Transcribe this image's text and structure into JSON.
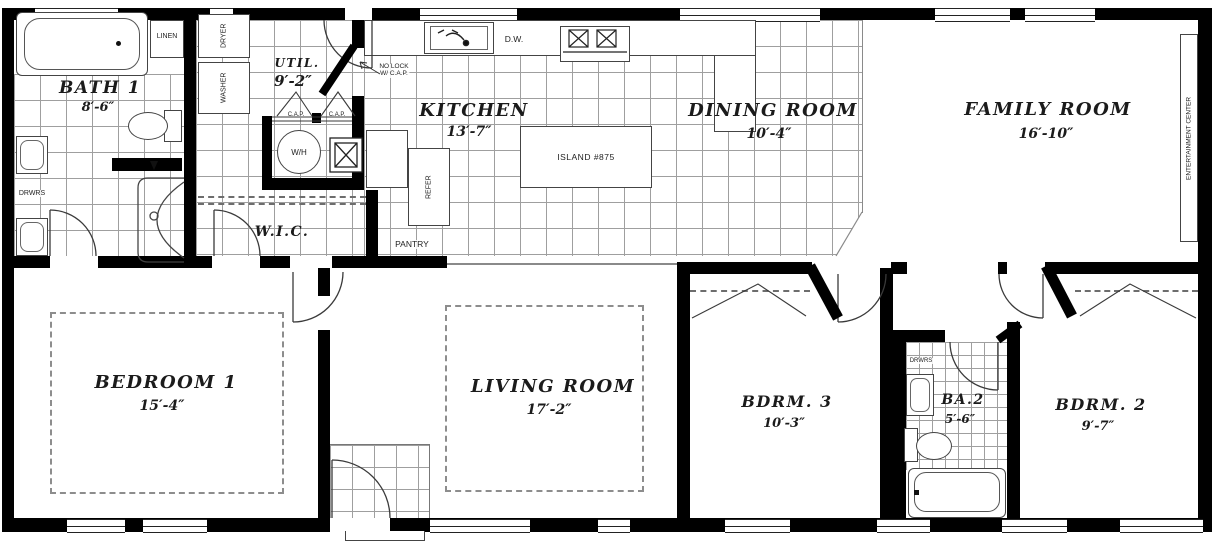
{
  "rooms": {
    "bath1": {
      "name": "BATH 1",
      "dim": "8′-6″"
    },
    "util": {
      "name": "UTIL.",
      "dim": "9′-2″"
    },
    "kitchen": {
      "name": "KITCHEN",
      "dim": "13′-7″"
    },
    "dining": {
      "name": "DINING ROOM",
      "dim": "10′-4″"
    },
    "family": {
      "name": "FAMILY ROOM",
      "dim": "16′-10″"
    },
    "bedroom1": {
      "name": "BEDROOM 1",
      "dim": "15′-4″"
    },
    "living": {
      "name": "LIVING ROOM",
      "dim": "17′-2″"
    },
    "bdrm3": {
      "name": "BDRM. 3",
      "dim": "10′-3″"
    },
    "ba2": {
      "name": "BA.2",
      "dim": "5′-6″"
    },
    "bdrm2": {
      "name": "BDRM. 2",
      "dim": "9′-7″"
    },
    "wic": {
      "name": "W.I.C."
    }
  },
  "fixtures": {
    "linen": "LINEN",
    "dryer": "DRYER",
    "washer": "WASHER",
    "drwrs_bath": "DRWRS",
    "wh": "W/H",
    "cap_left": "C.A.P.",
    "cap_right": "C.A.P.",
    "no_lock_1": "NO LOCK",
    "no_lock_2": "W/ C.A.P.",
    "dw": "D.W.",
    "island": "ISLAND #875",
    "refer": "REFER",
    "pantry": "PANTRY",
    "entertainment": "ENTERTAINMENT CENTER",
    "drwrs_ba2": "DRWRS"
  },
  "colors": {
    "wall": "#000000",
    "tile_line": "#9f9f9f",
    "background": "#ffffff"
  }
}
